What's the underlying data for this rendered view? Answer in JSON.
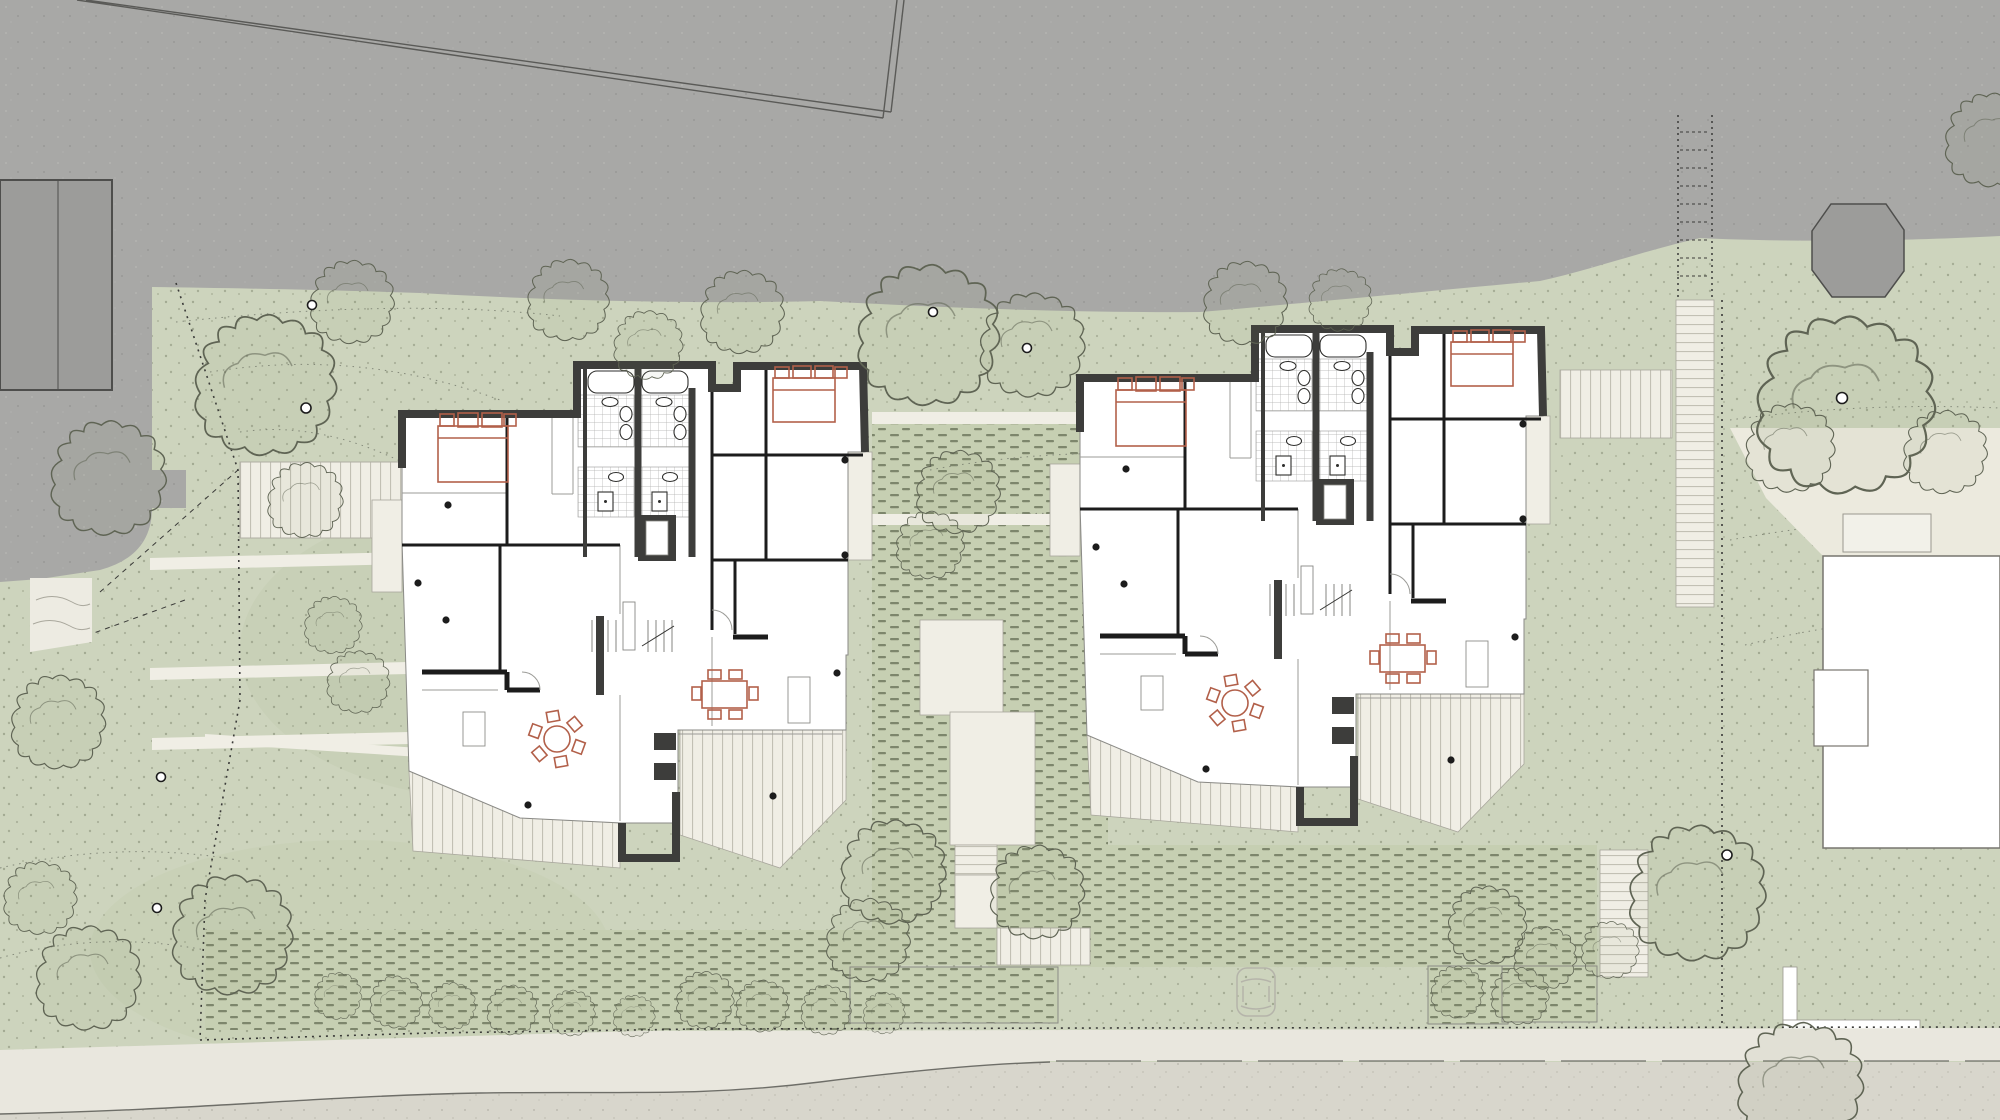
{
  "meta": {
    "type": "architectural-site-plan",
    "view": "ground-floor plan with landscape",
    "visible_text": "none"
  },
  "palette": {
    "neighbor_gray": "#a8a8a6",
    "parcel_building_gray": "#9c9c9a",
    "gray_noise": "#b4b4b2",
    "outline_dark": "#4e4e4c",
    "site_green": "#cdd4bd",
    "grass_blotch": "#c3ccb0",
    "hedge_green": "#c6cfb2",
    "hedge_dash": "#7d866c",
    "stipple": "#7f866f",
    "path_light": "#f0eee5",
    "steps_edge": "#a8a69c",
    "stripe_line": "#c2c0b4",
    "tile_line": "#aeaeab",
    "plan_white": "#ffffff",
    "slab_outline": "#8a8a86",
    "wall_dark": "#3d3d3b",
    "line_black": "#1c1c1c",
    "line_light": "#9b9b97",
    "furniture_red": "#b2604a",
    "tree_line": "#5f6454",
    "boundary": "#3a3a38",
    "road_verge": "#e9e7de",
    "road_asphalt": "#d8d6cc",
    "road_edge": "#6e6e68",
    "speckle": "#b2b0a5",
    "car_line": "#b5b4aa"
  },
  "scene": {
    "site": {
      "surroundings_top": "adjacent gray parcels with boundary lines and octagonal structure",
      "street_bottom": "curved road with sidewalk verge and one parked car",
      "landscape": {
        "tree_crowns": 30,
        "trunk_markers": 8,
        "hedge_rows": "dashed planting texture in courtyards and along street",
        "garden_steps": [
          "west terraced steps",
          "central courtyard stair",
          "east long exterior stair"
        ]
      }
    },
    "buildings": [
      {
        "name": "house-a",
        "units": 2,
        "features": [
          "two double beds",
          "four tiled bathrooms with tubs, wc and showers",
          "elevator shaft",
          "central stair",
          "round dining table with six chairs",
          "rectangular dining table with six chairs",
          "striped roof terraces"
        ]
      },
      {
        "name": "house-b",
        "units": 2,
        "features": [
          "two double beds",
          "four tiled bathrooms with tubs, wc and showers",
          "elevator shaft",
          "central stair",
          "round dining table with six chairs",
          "rectangular dining table with six chairs",
          "striped roof terraces"
        ]
      },
      {
        "name": "neighbor-house-east",
        "units": 1,
        "features": [
          "white footprint partially visible at right edge"
        ]
      },
      {
        "name": "neighbor-house-west",
        "units": 1,
        "features": [
          "gray outlined footprint on upper-left parcel"
        ]
      }
    ]
  }
}
